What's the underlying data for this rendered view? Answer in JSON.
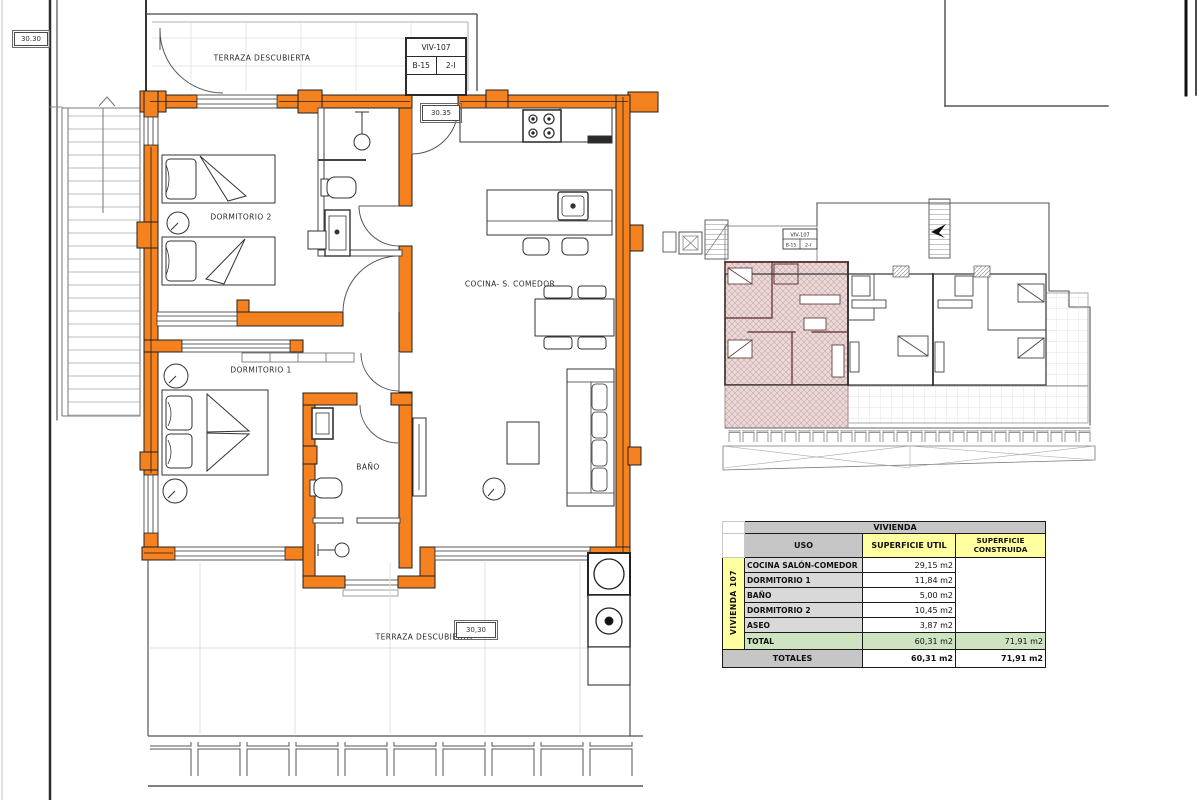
{
  "labels": {
    "dim_top_left": "30.30",
    "dim_entrance": "30.35",
    "dim_terrace_bottom": "30,30",
    "terraza_top": "TERRAZA DESCUBIERTA",
    "terraza_bottom": "TERRAZA DESCUBIERTA",
    "dormitorio2": "DORMITORIO 2",
    "dormitorio1": "DORMITORIO 1",
    "bano": "BAÑO",
    "cocina_comedor": "COCINA- S. COMEDOR"
  },
  "unit_tag": {
    "code": "VIV-107",
    "block": "B-15",
    "floor": "2-I"
  },
  "overview_tag": {
    "code": "VIV-107",
    "block": "B-15",
    "floor": "2-I"
  },
  "colors": {
    "wall_highlight": "#F5821F",
    "unit_highlight_fill": "#EBD9D9",
    "unit_highlight_wall": "#5A2B2B",
    "table_header_gray": "#C6C6C6",
    "table_yellow": "#FFFFA0",
    "table_green": "#CDE3C1",
    "table_row_gray": "#D9D9D9"
  },
  "table": {
    "title": "VIVIENDA",
    "columns": {
      "uso": "USO",
      "util": "SUPERFICIE UTIL",
      "construida": "SUPERFICIE CONSTRUIDA"
    },
    "side_label": "VIVIENDA 107",
    "rows": [
      {
        "label": "COCINA SALÓN-COMEDOR",
        "util": "29,15 m2"
      },
      {
        "label": "DORMITORIO 1",
        "util": "11,84 m2"
      },
      {
        "label": "BAÑO",
        "util": "5,00 m2"
      },
      {
        "label": "DORMITORIO 2",
        "util": "10,45 m2"
      },
      {
        "label": "ASEO",
        "util": "3,87 m2"
      }
    ],
    "total": {
      "label": "TOTAL",
      "util": "60,31 m2",
      "construida": "71,91 m2"
    },
    "totales": {
      "label": "TOTALES",
      "util": "60,31 m2",
      "construida": "71,91 m2"
    }
  }
}
